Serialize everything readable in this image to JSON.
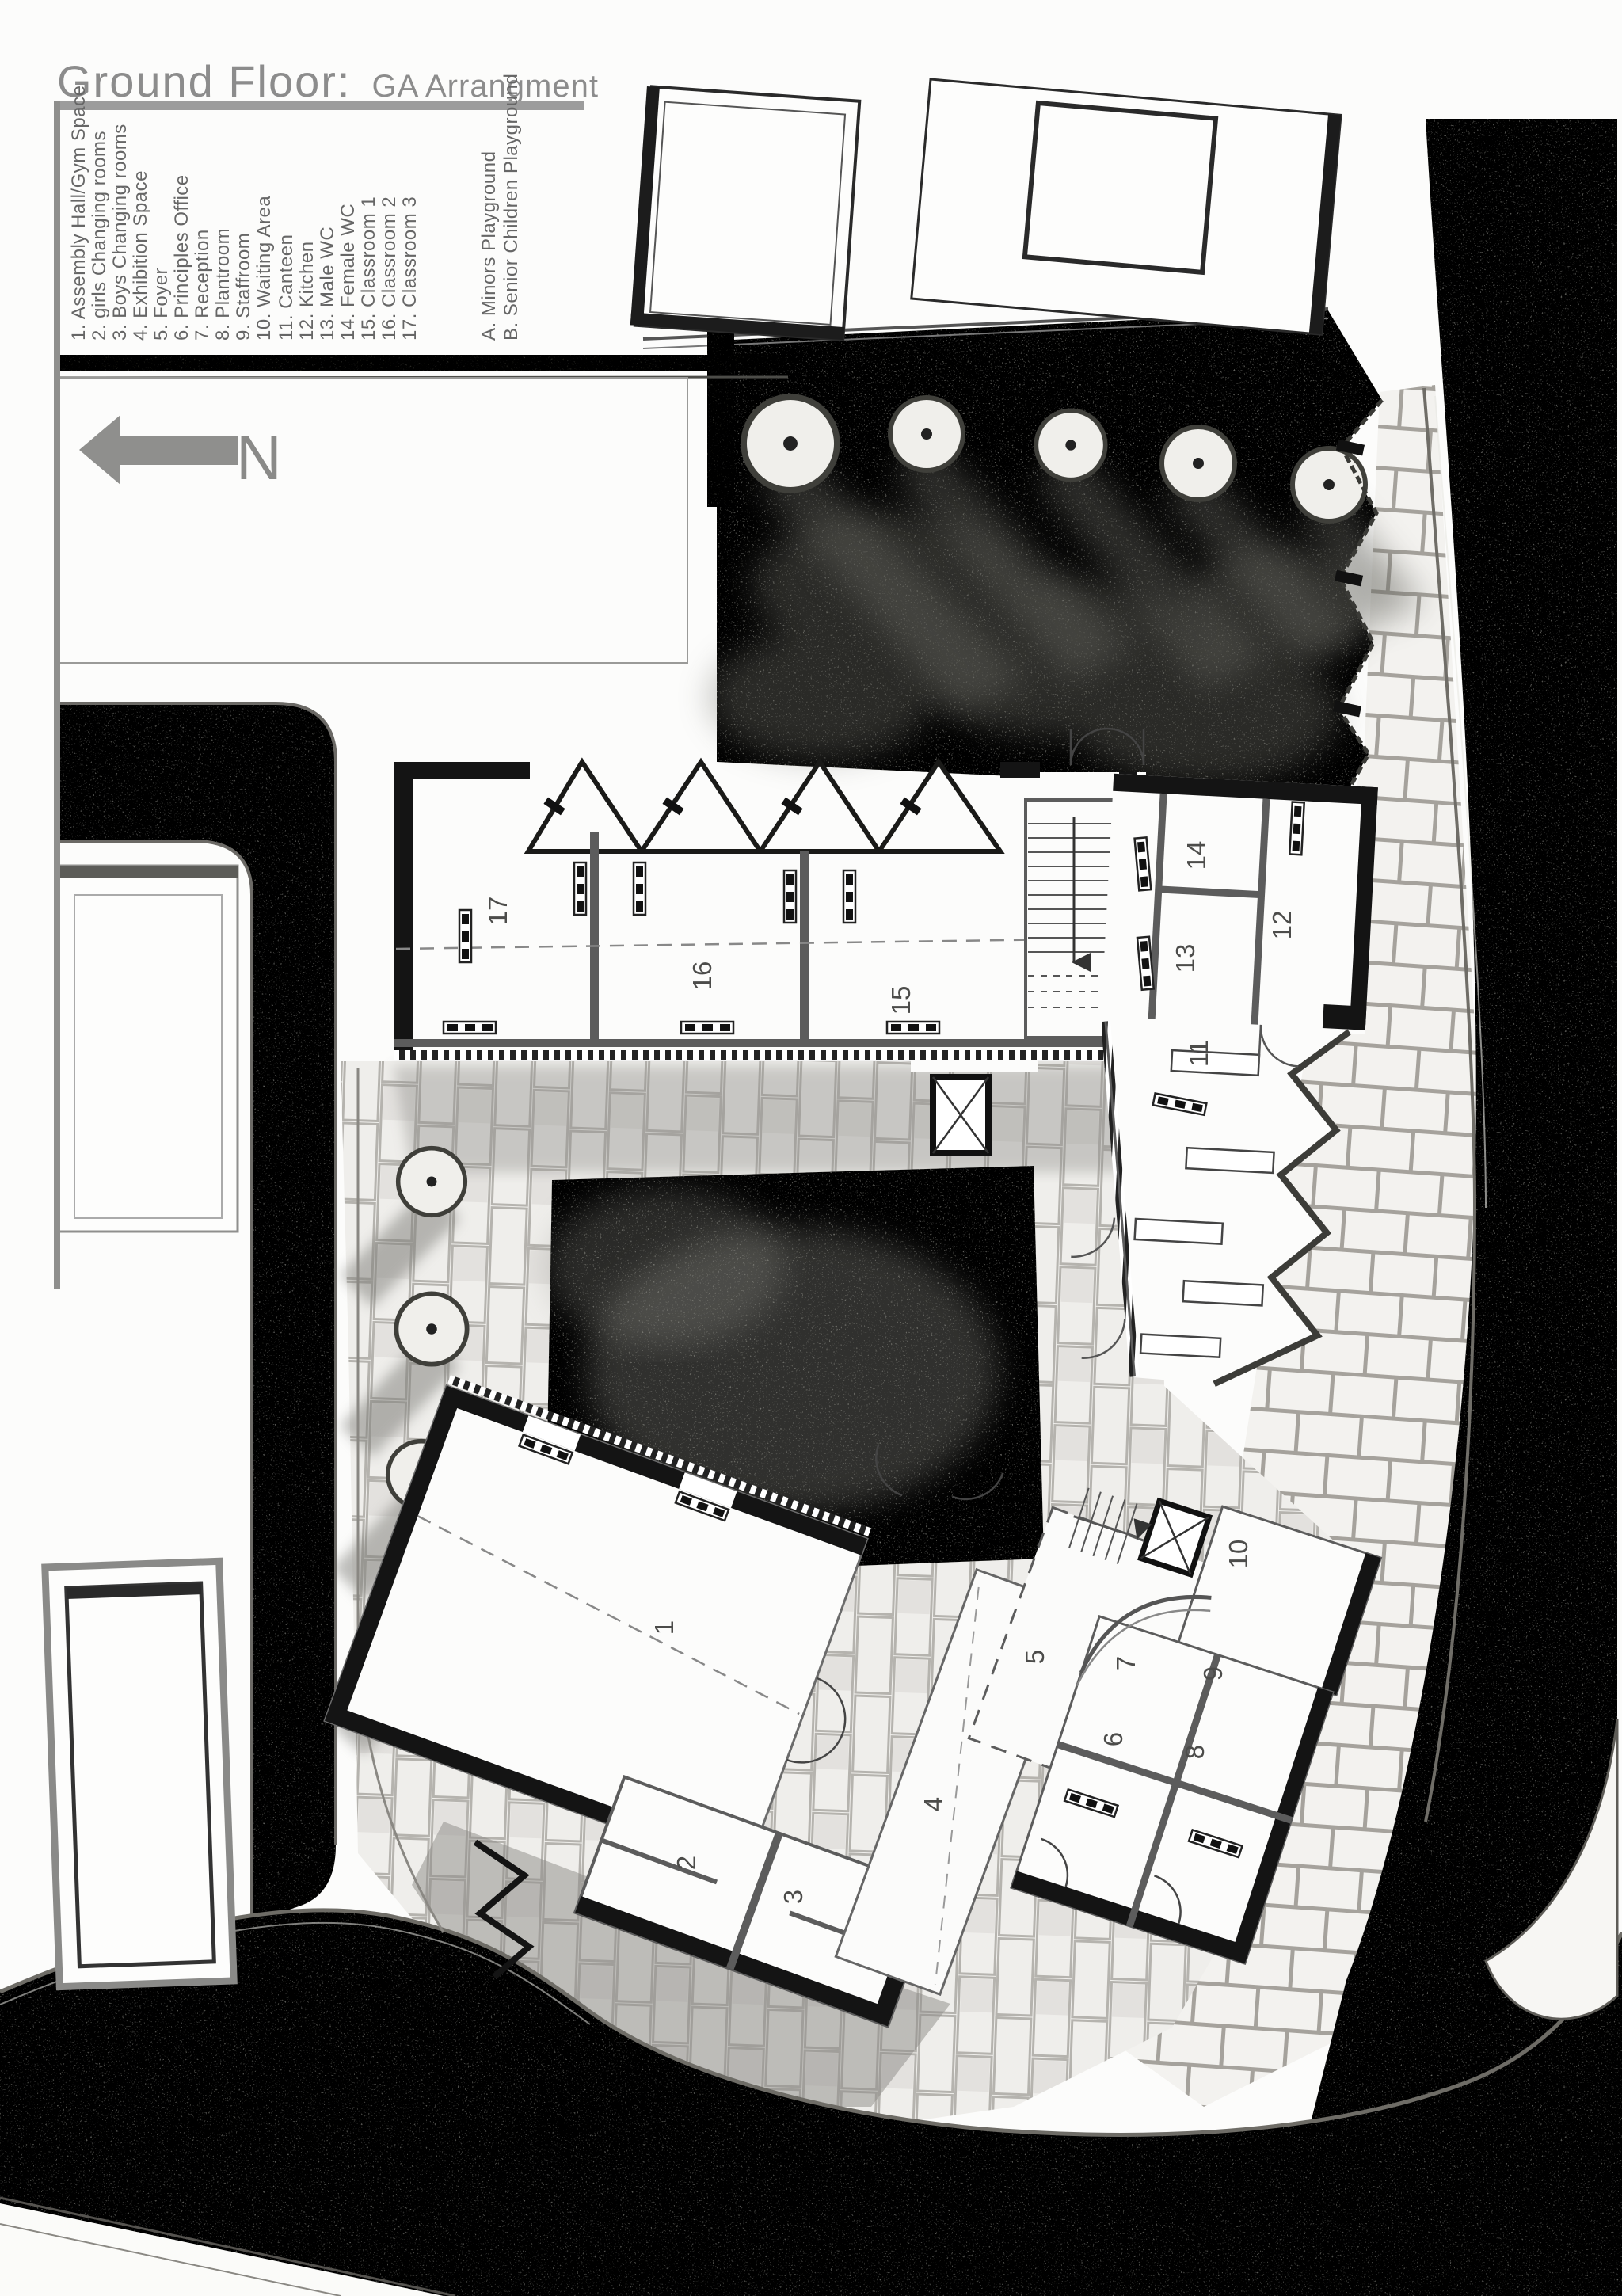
{
  "title": {
    "main": "Ground  Floor:",
    "sub": "GA  Arrangment"
  },
  "legend": {
    "items": [
      "1. Assembly Hall/Gym Space",
      "2. girls Changing rooms",
      "3. Boys Changing rooms",
      "4. Exhibition Space",
      "5. Foyer",
      "6. Principles Office",
      "7. Reception",
      "8. Plantroom",
      "9. Staffroom",
      "10. Waiting Area",
      "11. Canteen",
      "12. Kitchen",
      "13. Male WC",
      "14. Female WC",
      "15. Classroom 1",
      "16. Classroom 2",
      "17. Classroom 3"
    ],
    "playgrounds": [
      "A. Minors Playground",
      "B. Senior Children Playground"
    ]
  },
  "north": {
    "label": "N"
  },
  "plan": {
    "room_labels": [
      "1",
      "2",
      "3",
      "4",
      "5",
      "6",
      "7",
      "8",
      "9",
      "10",
      "11",
      "12",
      "13",
      "14",
      "15",
      "16",
      "17"
    ]
  },
  "colors": {
    "title_gray": "#8c8c8c",
    "legend_gray": "#666666",
    "road_gray": "#95958f",
    "playground_gray": "#a7a7a0",
    "wall_black": "#161616",
    "partition_gray": "#5c5c5c"
  }
}
